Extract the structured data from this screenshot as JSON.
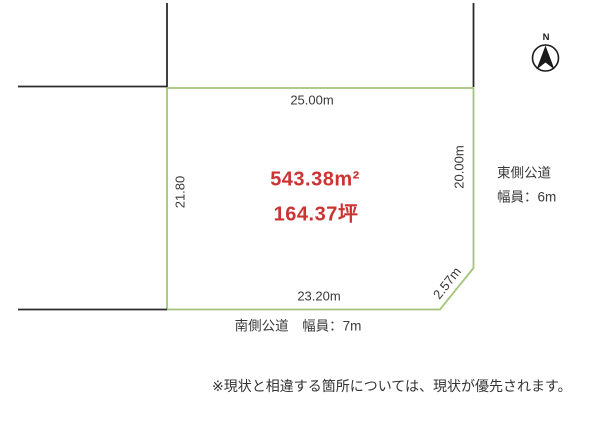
{
  "site_plan": {
    "dimensions": {
      "top": "25.00m",
      "left": "21.80",
      "right": "20.00m",
      "bottom": "23.20m",
      "corner": "2.57m"
    },
    "area": {
      "square_meters": "543.38m²",
      "tsubo": "164.37坪"
    },
    "roads": {
      "east_name": "東側公道",
      "east_width": "幅員：6m",
      "south": "南側公道　幅員：7m"
    },
    "compass": {
      "label": "N"
    },
    "note": "※現状と相違する箇所については、現状が優先されます。",
    "colors": {
      "plot_border": "#a4c47c",
      "boundary_line": "#2b2b2b",
      "area_text": "#cc3333",
      "label_text": "#3a3a3a"
    }
  }
}
